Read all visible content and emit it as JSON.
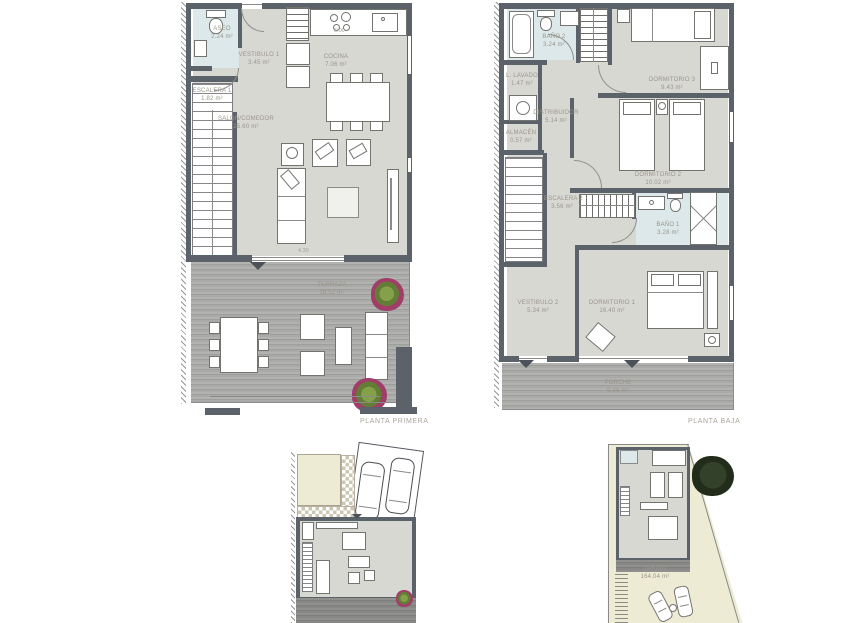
{
  "page": {
    "background": "#ffffff"
  },
  "planta_primera": {
    "title": "PLANTA PRIMERA",
    "rooms": {
      "aseo": {
        "name": "ASEO",
        "area": "2.24 m²"
      },
      "vestibulo1": {
        "name": "VESTIBULO 1",
        "area": "3.45 m²"
      },
      "cocina": {
        "name": "COCINA",
        "area": "7.06 m²"
      },
      "escalera1": {
        "name": "ESCALERA 1",
        "area": "1.82 m²"
      },
      "salon": {
        "name": "SALON/COMEDOR",
        "area": "25.60 m²"
      },
      "terraza": {
        "name": "TERRAZA",
        "area": "28.52 m²"
      }
    },
    "dimensions": {
      "kitchen_width": "6.00",
      "salon_width": "4.30"
    }
  },
  "planta_baja": {
    "title": "PLANTA BAJA",
    "rooms": {
      "bano2": {
        "name": "BAÑO 2",
        "area": "3.24 m²"
      },
      "lavado": {
        "name": "L. LAVADO",
        "area": "1.47 m²"
      },
      "almacen": {
        "name": "ALMACÉN",
        "area": "0.57 m²"
      },
      "distribuidor": {
        "name": "DISTRIBUIDOR",
        "area": "5.14 m²"
      },
      "dormitorio3": {
        "name": "DORMITORIO 3",
        "area": "9.43 m²"
      },
      "dormitorio2": {
        "name": "DORMITORIO 2",
        "area": "10.02 m²"
      },
      "escalera2": {
        "name": "ESCALERA 2",
        "area": "3.56 m²"
      },
      "bano1": {
        "name": "BAÑO 1",
        "area": "3.28 m²"
      },
      "vestibulo2": {
        "name": "VESTIBULO 2",
        "area": "5.34 m²"
      },
      "dormitorio1": {
        "name": "DORMITORIO 1",
        "area": "16.40 m²"
      },
      "porche": {
        "name": "PORCHE",
        "area": "9.86 m²"
      }
    }
  },
  "site_plans": {
    "jardin": {
      "name": "JARDÍN",
      "area": "164.04 m²"
    }
  },
  "colors": {
    "wall": "#5c626a",
    "floor": "#d8d8d3",
    "bathroom_floor": "#dce8e9",
    "garden": "#eeebd5",
    "deck": "#a9a9a7",
    "plant_magenta": "#a03d68",
    "plant_green": "#85a04a",
    "label_text": "#9a958b"
  }
}
